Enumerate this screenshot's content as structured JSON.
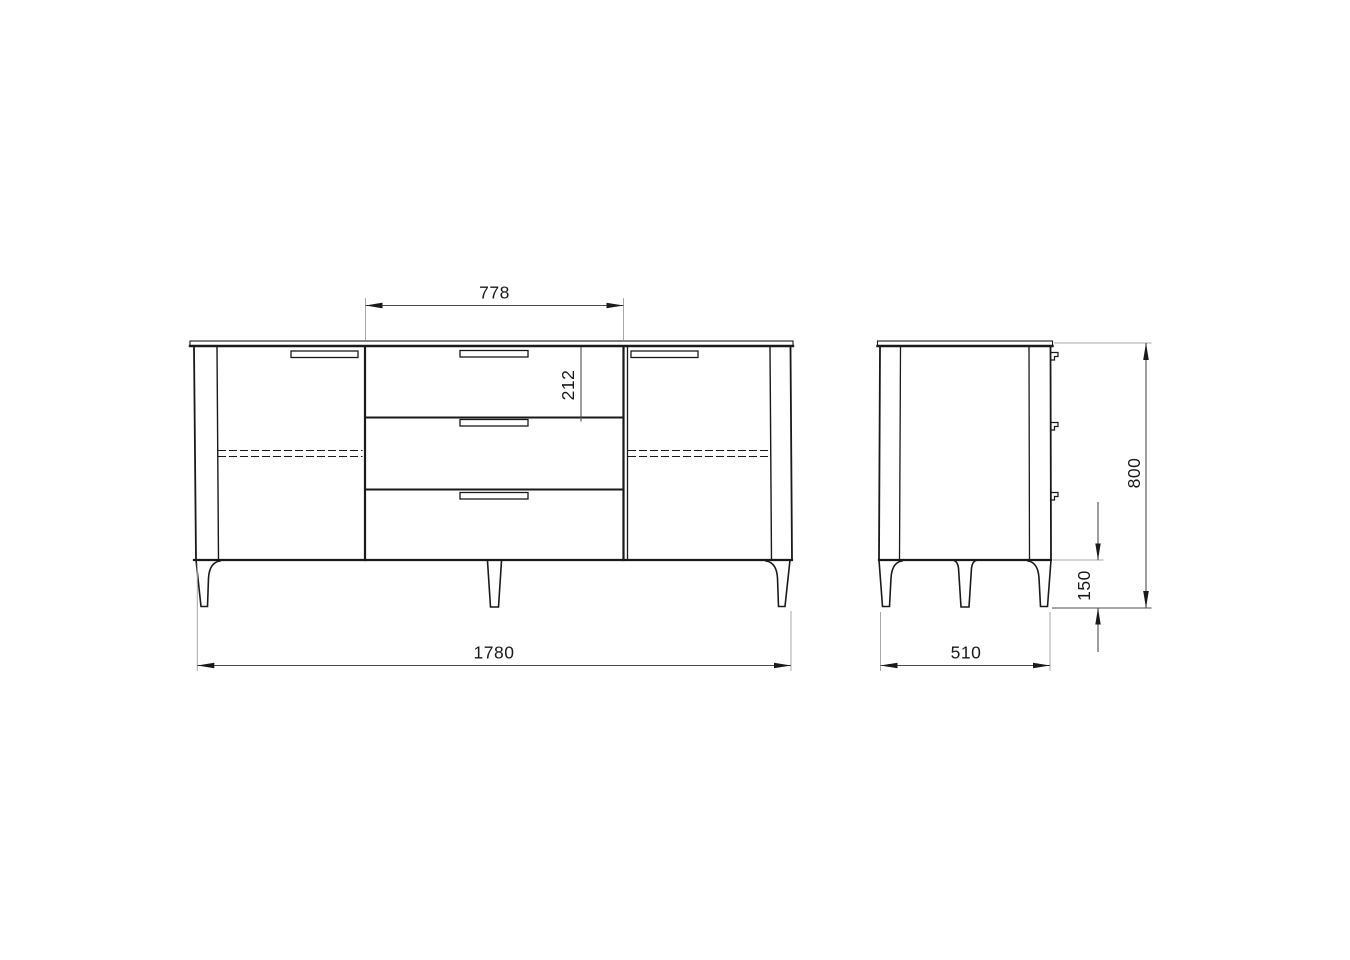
{
  "drawing": {
    "kind": "furniture-technical-drawing",
    "subject": "sideboard with two doors and three central drawers",
    "views": [
      "front",
      "side"
    ]
  },
  "dimensions": {
    "overall_width": "1780",
    "drawer_section_width": "778",
    "top_drawer_height": "212",
    "overall_height": "800",
    "leg_height": "150",
    "depth": "510"
  },
  "colors": {
    "background": "#ffffff",
    "object_line": "#1a1a1a",
    "dimension_line": "#4d4d4d",
    "extension_line": "#a8a8a8",
    "text": "#1a1a1a"
  }
}
